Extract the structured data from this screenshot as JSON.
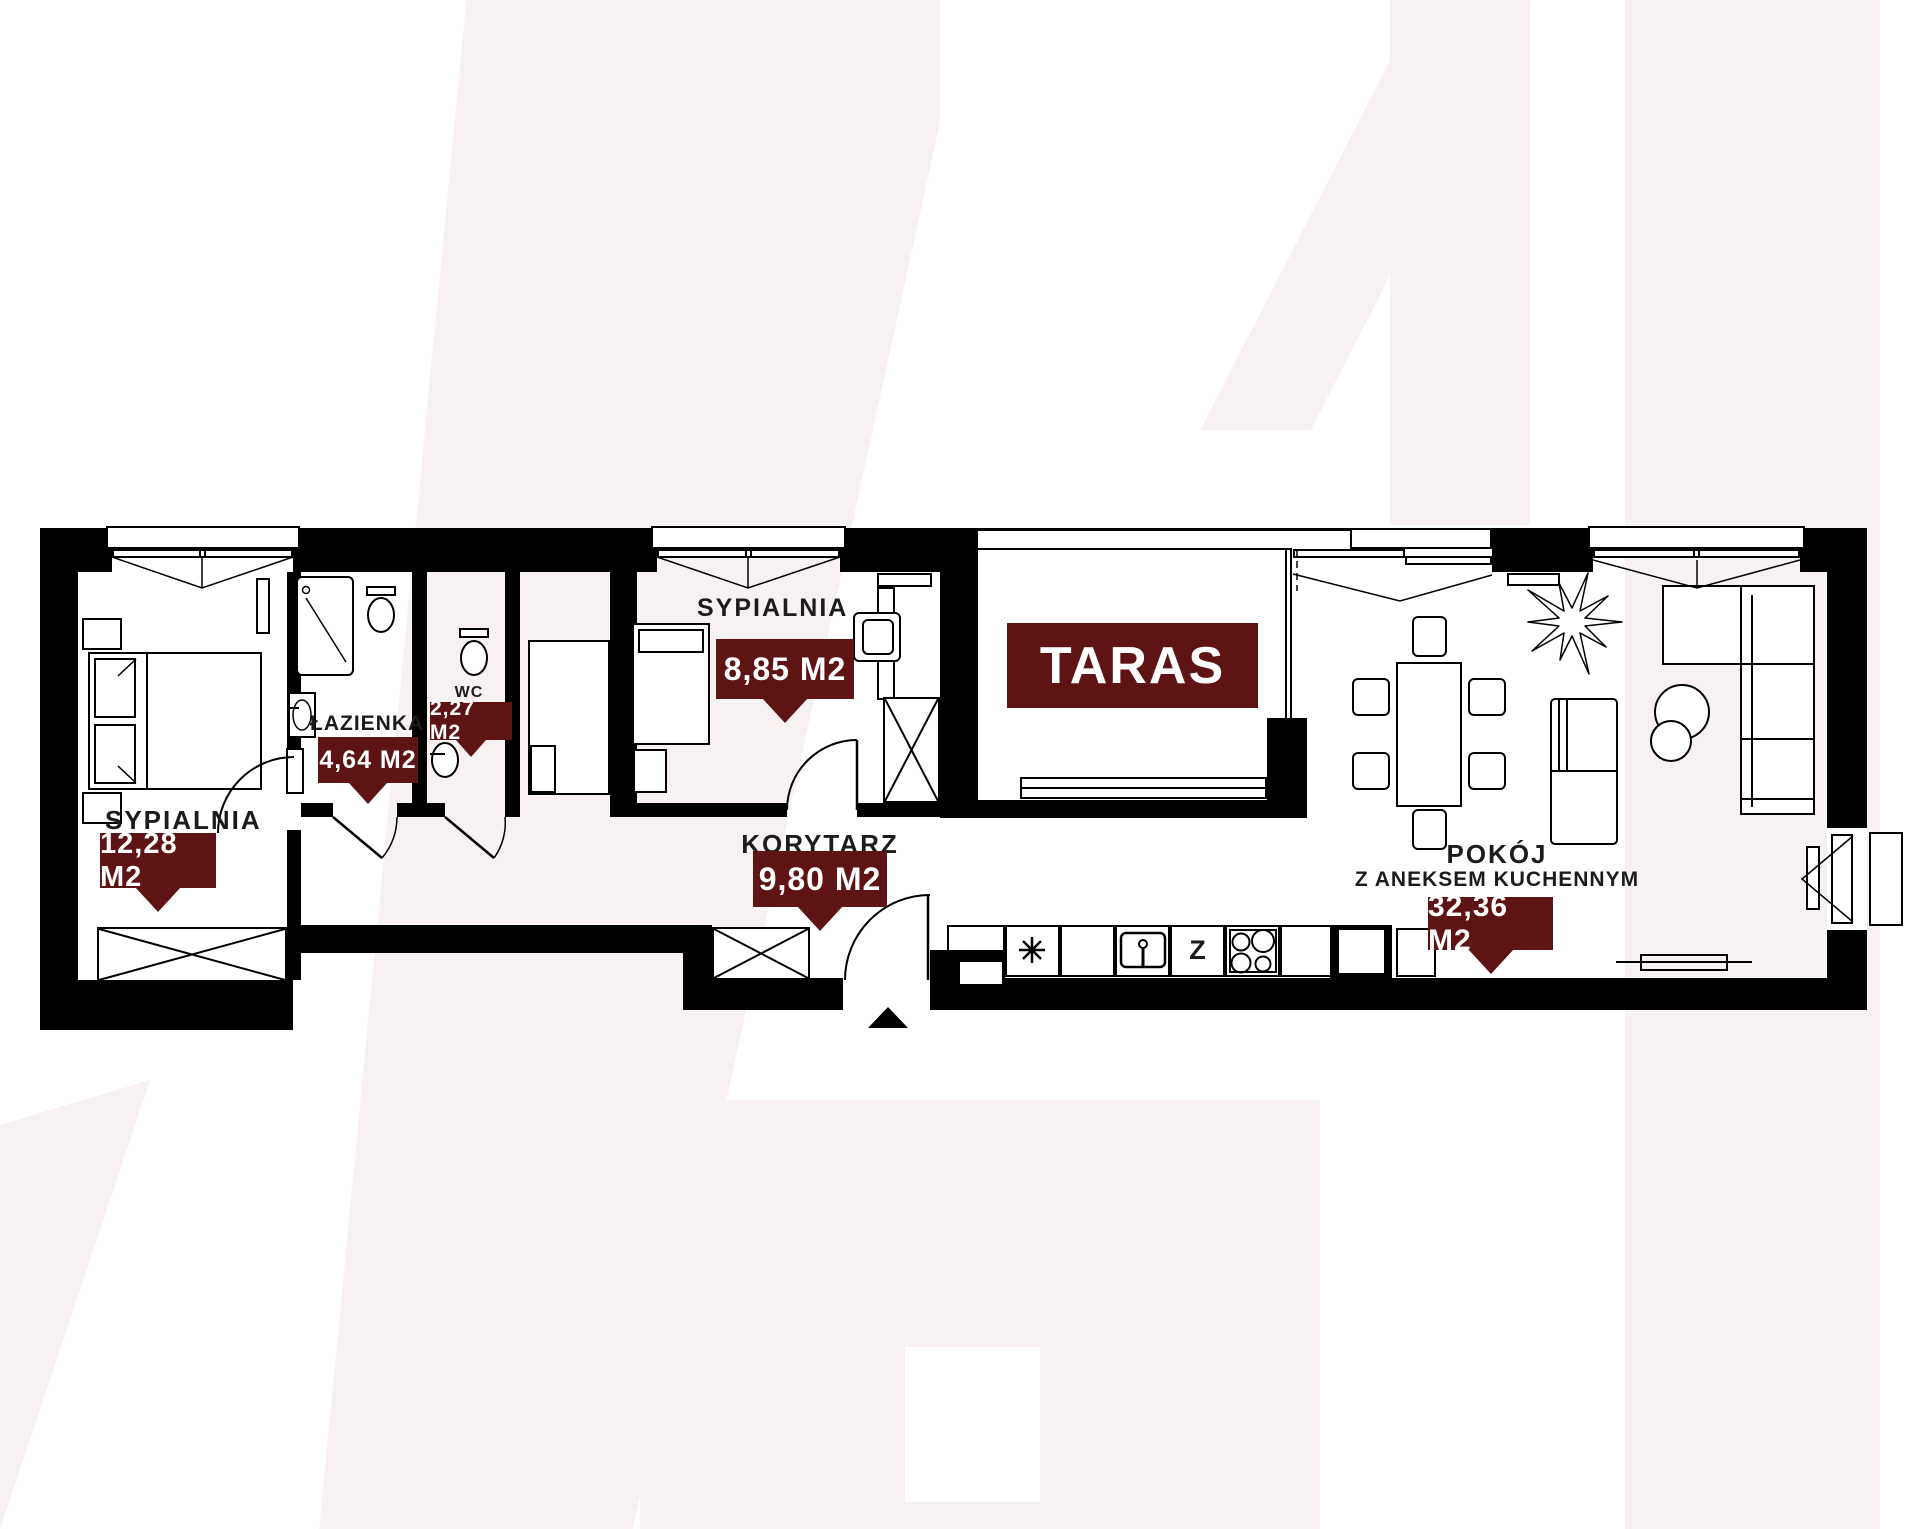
{
  "rooms": {
    "bedroom1": {
      "label": "SYPIALNIA",
      "area": "12,28 M2"
    },
    "bathroom": {
      "label": "ŁAZIENKA",
      "area": "4,64 M2"
    },
    "wc": {
      "label": "WC",
      "area": "2,27 M2"
    },
    "bedroom2": {
      "label": "SYPIALNIA",
      "area": "8,85 M2"
    },
    "corridor": {
      "label": "KORYTARZ",
      "area": "9,80 M2"
    },
    "terrace": {
      "label": "TARAS"
    },
    "living_room": {
      "label_line1": "POKÓJ",
      "label_line2": "Z ANEKSEM KUCHENNYM",
      "area": "32,36 M2"
    }
  },
  "kitchen": {
    "appliance_z_label": "Z"
  },
  "colors": {
    "wall": "#000000",
    "area_badge": "#5e1414",
    "watermark": "#f8f1f2",
    "label_text": "#1c1c1c"
  }
}
